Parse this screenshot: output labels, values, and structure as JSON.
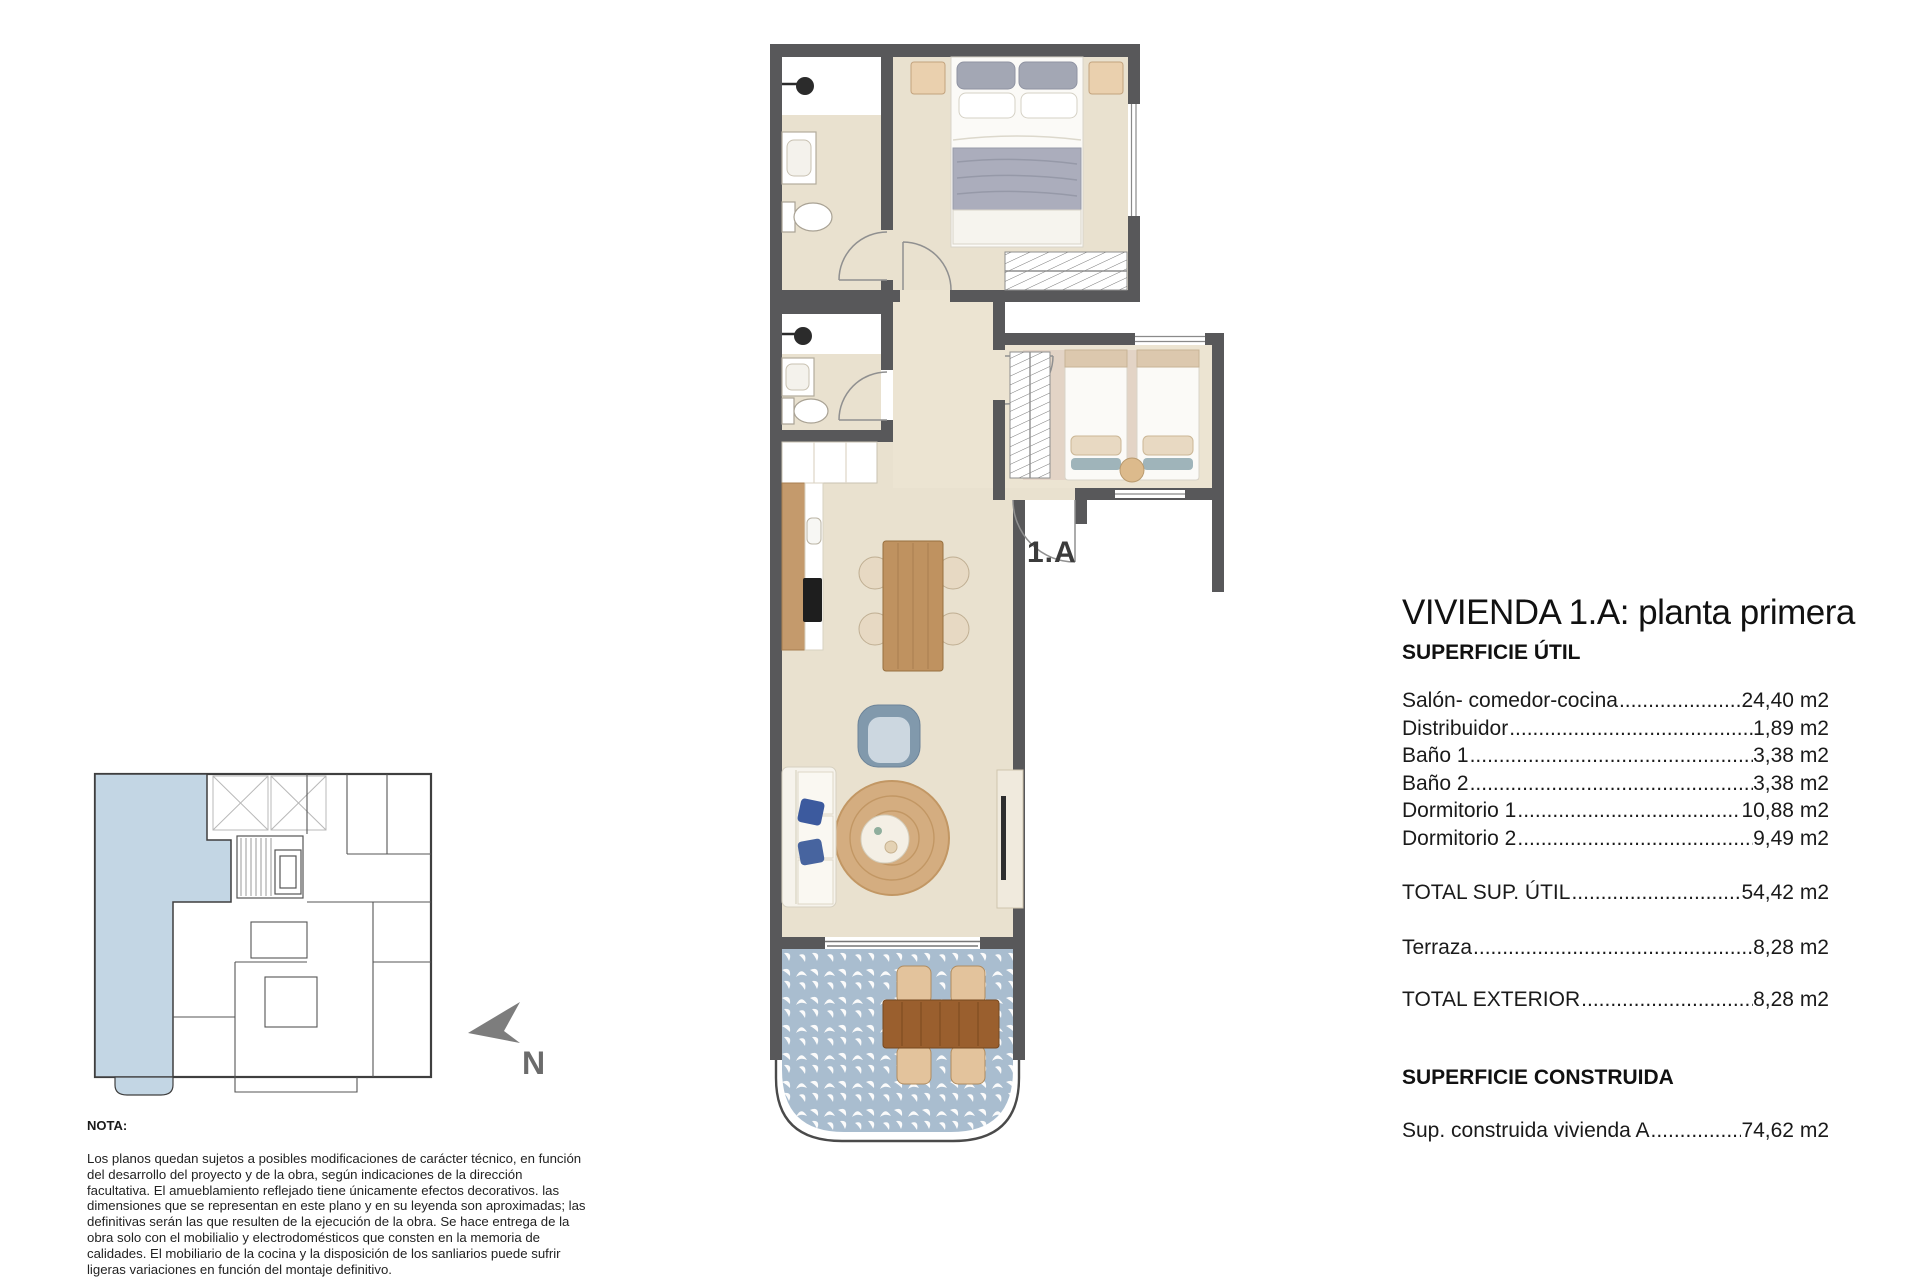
{
  "plan": {
    "unit_label": "1.A",
    "colors": {
      "wall": "#58585a",
      "floor": "#e9e1cf",
      "terrace_tile": "#a9bdcf",
      "wood": "#c49a6c",
      "rug": "#d4ad80",
      "highlight_blue": "#c3d6e4"
    },
    "furniture_icons": [
      "double-bed",
      "single-bed",
      "nightstand",
      "wardrobe",
      "shower",
      "sink",
      "toilet",
      "kitchen-counter",
      "cooktop",
      "dining-table",
      "chair",
      "armchair",
      "sofa",
      "rug",
      "coffee-table",
      "tv-unit",
      "terrace-table",
      "terrace-chair",
      "pouf"
    ]
  },
  "key_plan": {
    "north_label": "N",
    "highlighted_unit": "1.A"
  },
  "details": {
    "title": "VIVIENDA 1.A: planta primera",
    "section1_heading": "SUPERFICIE ÚTIL",
    "rows": [
      {
        "label": "Salón- comedor-cocina",
        "value": "24,40 m2"
      },
      {
        "label": "Distribuidor",
        "value": "1,89 m2"
      },
      {
        "label": "Baño 1",
        "value": "3,38 m2"
      },
      {
        "label": "Baño 2",
        "value": "3,38 m2"
      },
      {
        "label": "Dormitorio 1",
        "value": "10,88 m2"
      },
      {
        "label": "Dormitorio 2",
        "value": "9,49 m2"
      }
    ],
    "total_util": {
      "label": "TOTAL SUP. ÚTIL",
      "value": "54,42 m2"
    },
    "terraza": {
      "label": "Terraza",
      "value": "8,28 m2"
    },
    "total_exterior": {
      "label": "TOTAL EXTERIOR",
      "value": "8,28 m2"
    },
    "section2_heading": "SUPERFICIE CONSTRUIDA",
    "construida": {
      "label": "Sup. construida vivienda A",
      "value": "74,62 m2"
    },
    "leader_dots": "............................................................................................................................................"
  },
  "note": {
    "heading": "NOTA:",
    "body": "Los planos quedan sujetos a posibles modificaciones de carácter técnico, en función del desarrollo del proyecto y de la obra, según indicaciones de la dirección facultativa. El amueblamiento reflejado tiene únicamente efectos decorativos. las dimensiones que se representan en este plano y en su leyenda son aproximadas; las definitivas serán las que resulten de la ejecución de la obra. Se hace entrega de la obra solo con el mobilialio y electrodomésticos que consten en la memoria de calidades. El mobiliario de la cocina y la disposición de los sanliarios puede sufrir ligeras variaciones en función del montaje definitivo."
  }
}
